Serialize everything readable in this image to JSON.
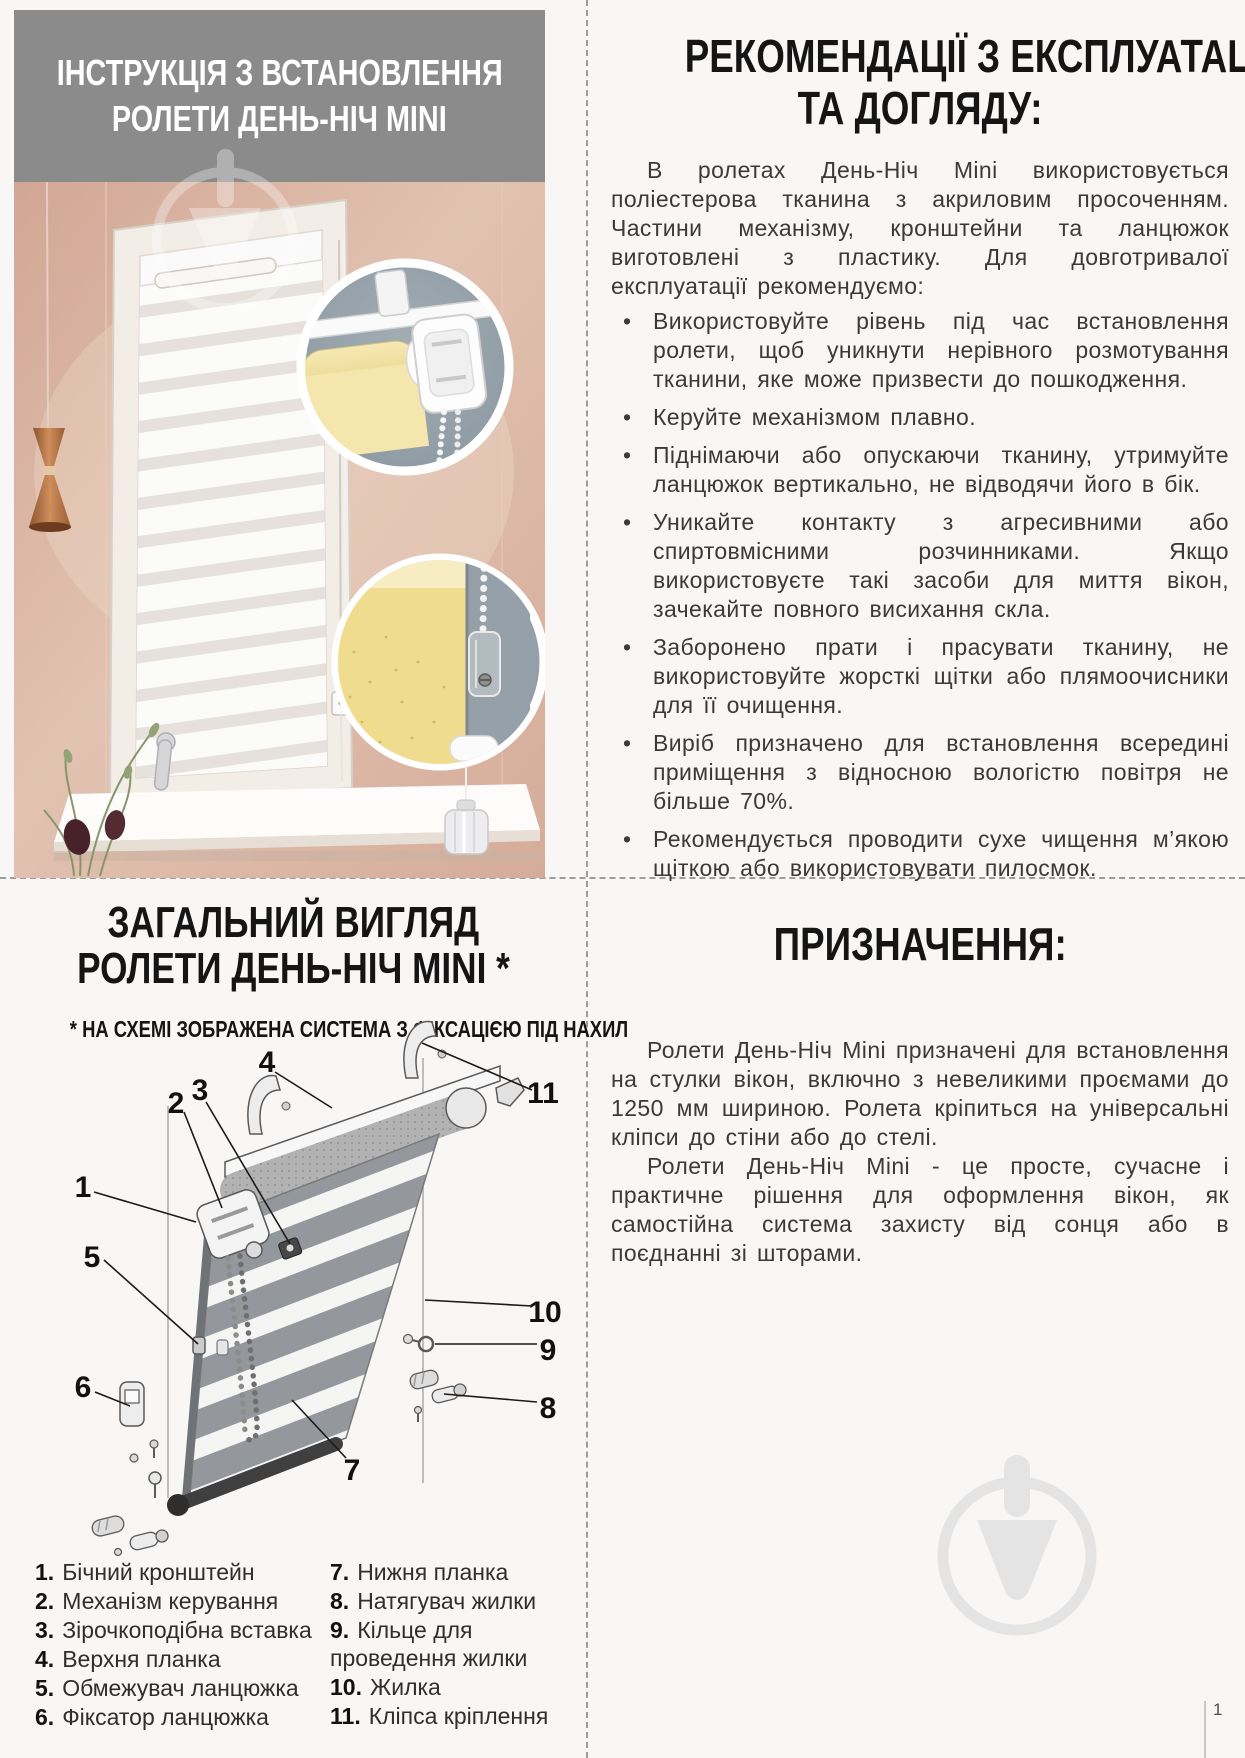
{
  "page": {
    "number": "1"
  },
  "colors": {
    "banner_gray": "#8b8b8b",
    "wall_pink": "#d8b2a2",
    "inset_gray": "#95a0a8",
    "fabric_yellow": "#f1dd90",
    "watermark_gray": "#e4e4e4"
  },
  "top_left": {
    "banner_line1": "ІНСТРУКЦІЯ З ВСТАНОВЛЕННЯ",
    "banner_line2": "РОЛЕТИ ДЕНЬ-НІЧ MINI"
  },
  "top_right": {
    "heading_line1": "РЕКОМЕНДАЦІЇ З ЕКСПЛУАТАЦІЇ",
    "heading_line2": "ТА ДОГЛЯДУ:",
    "intro": "В ролетах День-Ніч Mini використовується поліестерова тканина з акриловим просоченням. Частини механізму, кронштейни та ланцюжок виготовлені з пластику. Для довготривалої експлуатації рекомендуємо:",
    "bullets": [
      "Використовуйте рівень під час встановлення ролети, щоб уникнути нерівного розмотування тканини, яке може призвести до пошкодження.",
      "Керуйте механізмом плавно.",
      "Піднімаючи або опускаючи тканину, утримуйте ланцюжок вертикально, не відводячи його в бік.",
      "Уникайте контакту з агресивними або спиртовмісними розчинниками. Якщо використовуєте такі засоби для миття вікон, зачекайте повного висихання скла.",
      "Заборонено прати і прасувати тканину, не використовуйте жорсткі щітки або плямоочисники для її очищення.",
      "Виріб призначено для встановлення всередині приміщення з відносною вологістю повітря не більше 70%.",
      "Рекомендується проводити сухе чищення м’якою щіткою або використовувати пилосмок."
    ]
  },
  "bottom_left": {
    "heading_line1": "ЗАГАЛЬНИЙ ВИГЛЯД",
    "heading_line2": "РОЛЕТИ ДЕНЬ-НІЧ MINI *",
    "subheading": "* НА СХЕМІ ЗОБРАЖЕНА СИСТЕМА З ФІКСАЦІЄЮ ПІД НАХИЛ",
    "callouts": [
      "1",
      "2",
      "3",
      "4",
      "5",
      "6",
      "7",
      "8",
      "9",
      "10",
      "11"
    ],
    "legend_left": [
      {
        "num": "1.",
        "label": "Бічний кронштейн"
      },
      {
        "num": "2.",
        "label": "Механізм керування"
      },
      {
        "num": "3.",
        "label": "Зірочкоподібна вставка"
      },
      {
        "num": "4.",
        "label": "Верхня планка"
      },
      {
        "num": "5.",
        "label": "Обмежувач ланцюжка"
      },
      {
        "num": "6.",
        "label": "Фіксатор ланцюжка"
      }
    ],
    "legend_right": [
      {
        "num": "7.",
        "label": "Нижня планка"
      },
      {
        "num": "8.",
        "label": "Натягувач жилки"
      },
      {
        "num": "9.",
        "label": "Кільце для проведення жилки"
      },
      {
        "num": "10.",
        "label": "Жилка"
      },
      {
        "num": "11.",
        "label": "Кліпса кріплення"
      }
    ]
  },
  "bottom_right": {
    "heading": "ПРИЗНАЧЕННЯ:",
    "para1": "Ролети День-Ніч Mini призначені для встановлення на стулки вікон, включно з невеликими проємами до 1250 мм шириною. Ролета кріпиться на універсальні кліпси до стіни або до стелі.",
    "para2": "Ролети День-Ніч Mini - це просте, сучасне і практичне рішення для оформлення вікон, як самостійна система захисту від сонця або в поєднанні зі шторами."
  }
}
